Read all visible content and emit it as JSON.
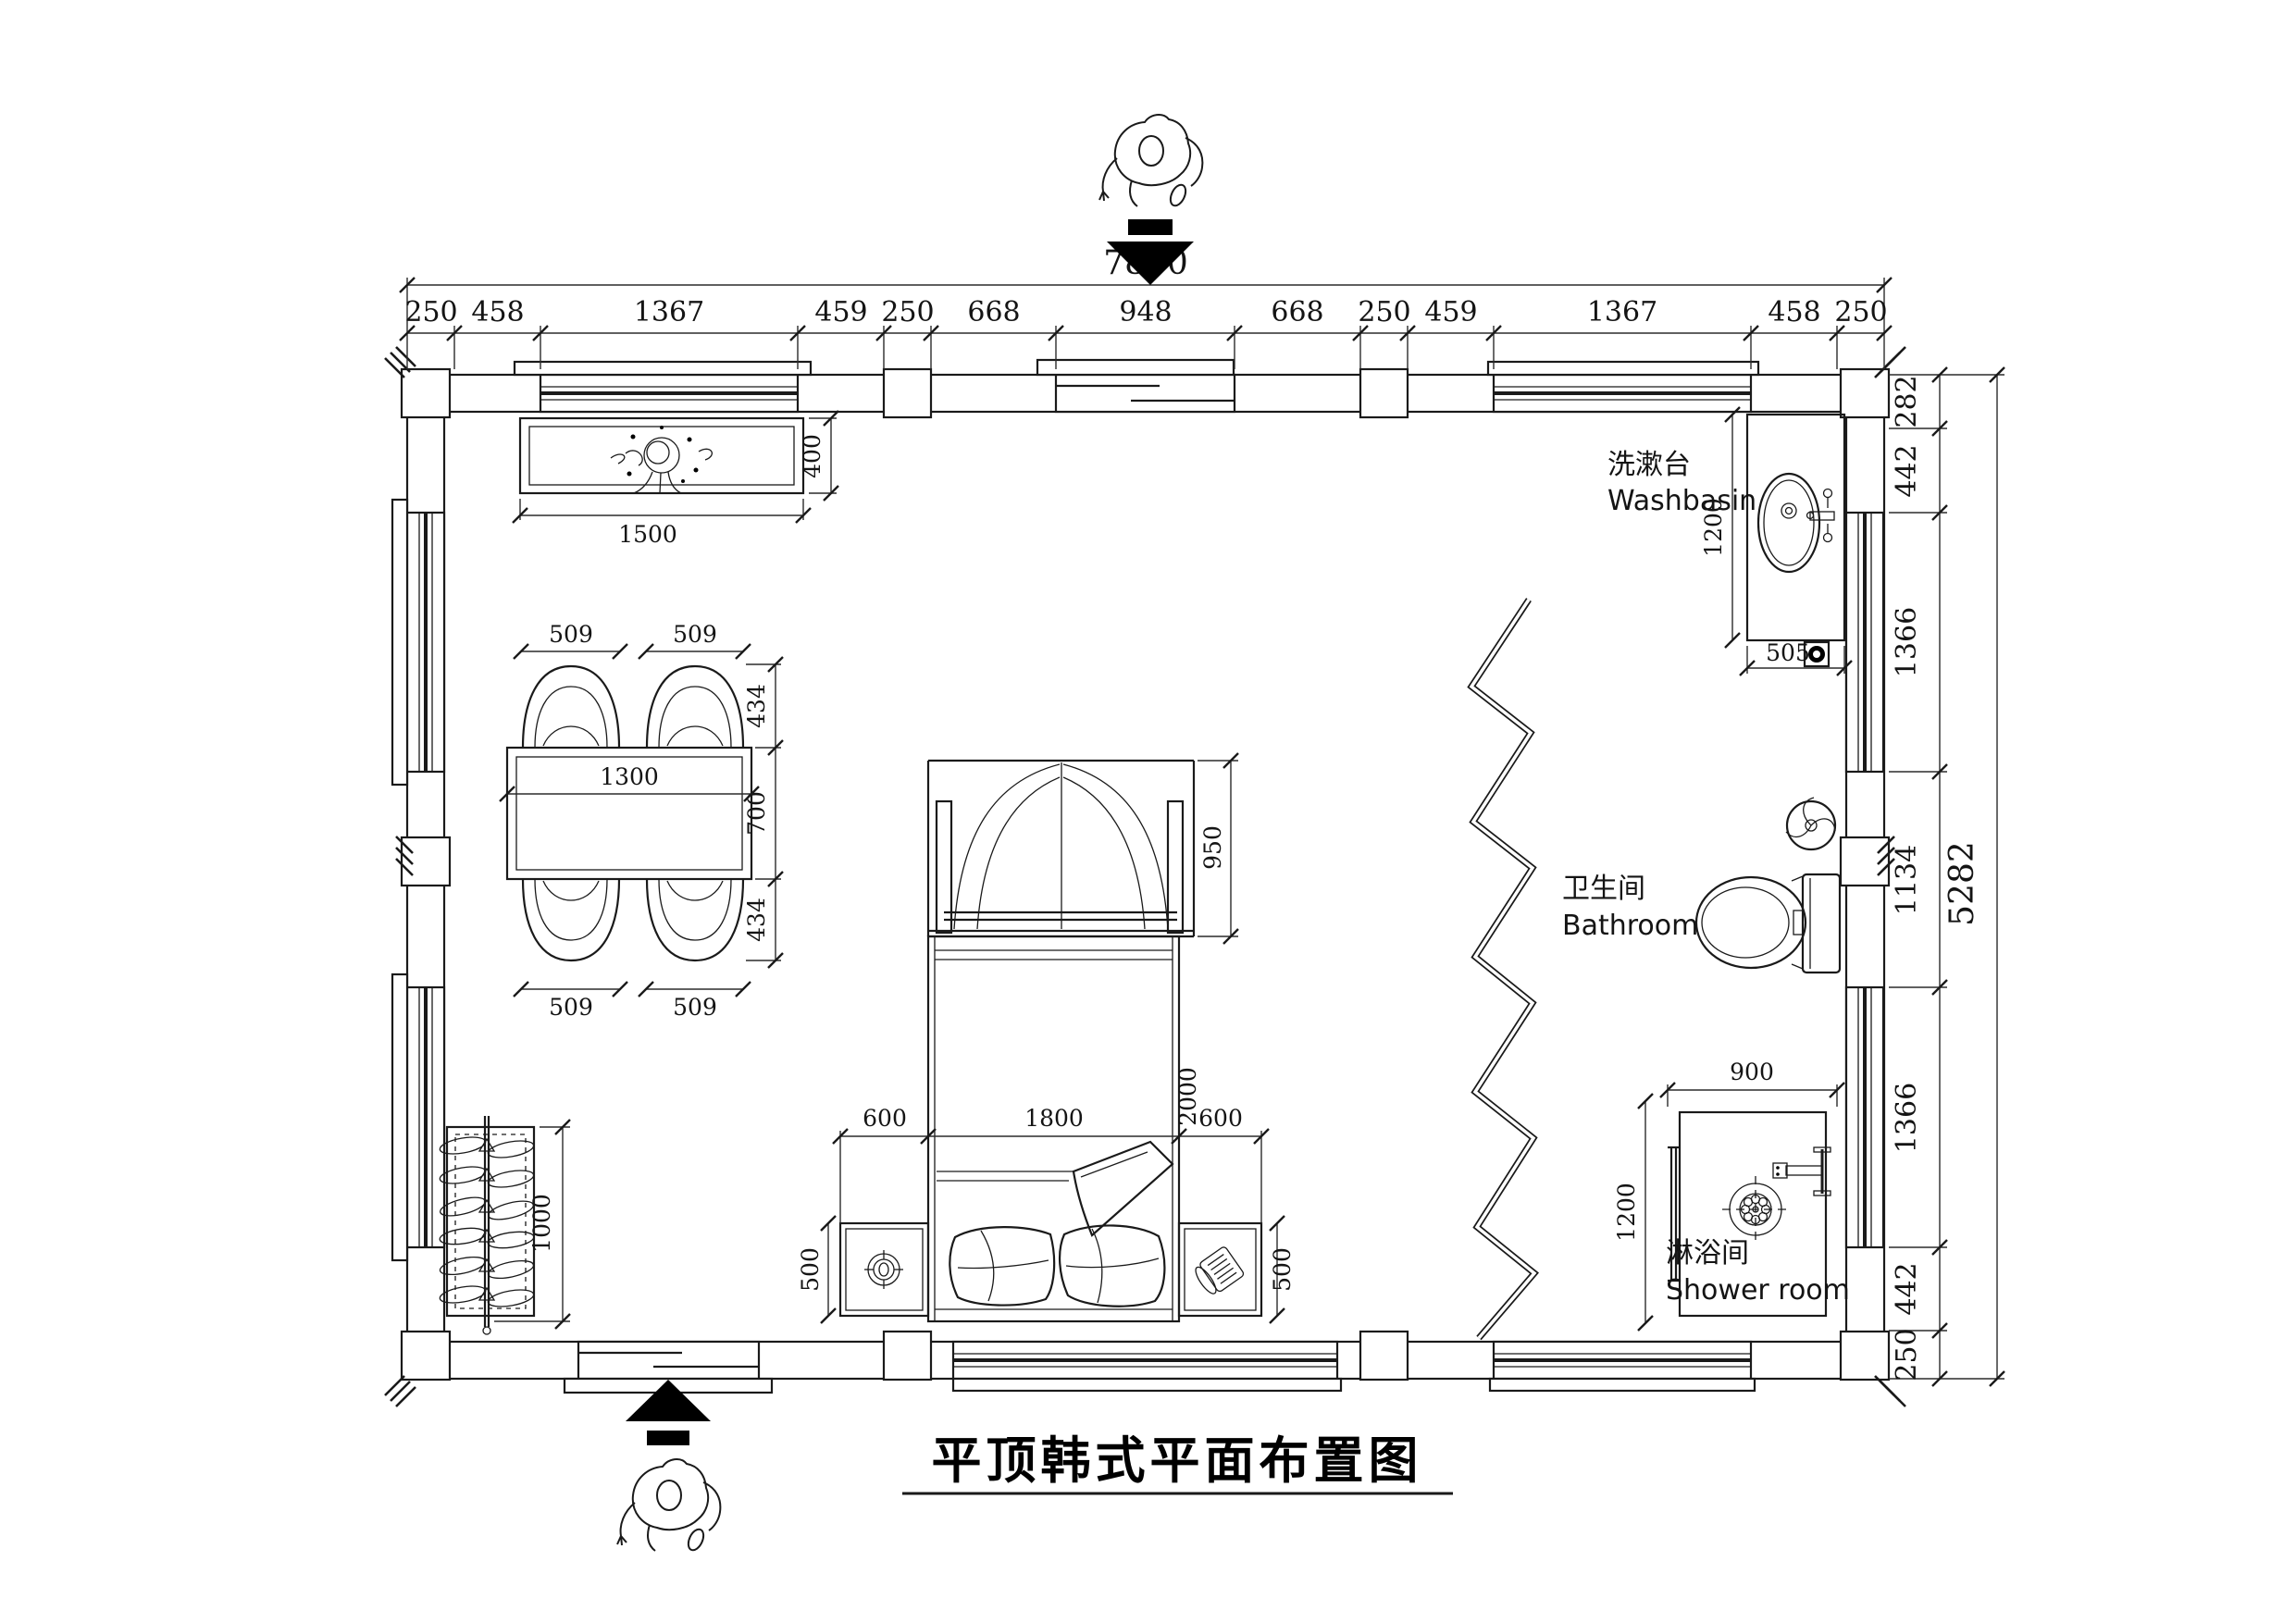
{
  "title": "平顶韩式平面布置图",
  "dimensions": {
    "top": {
      "overall": "7850",
      "segments": [
        "250",
        "458",
        "1367",
        "459",
        "250",
        "668",
        "948",
        "668",
        "250",
        "459",
        "1367",
        "458",
        "250"
      ]
    },
    "right": {
      "overall": "5282",
      "segments": [
        "282",
        "442",
        "1366",
        "1134",
        "1366",
        "442",
        "250"
      ]
    },
    "cabinet": {
      "length": "1500",
      "depth": "400"
    },
    "dining": {
      "table_length": "1300",
      "table_depth": "700",
      "chair_width": "509",
      "chair_depth": "434"
    },
    "bed": {
      "side_left": "600",
      "width": "1800",
      "side_right": "600",
      "length": "2000",
      "headboard": "950"
    },
    "nightstand_depth": "500",
    "wardrobe_length": "1000",
    "washbasin": {
      "counter_length": "1200",
      "counter_width": "505"
    },
    "shower": {
      "width": "900",
      "depth": "1200"
    }
  },
  "labels": {
    "washbasin": {
      "zh": "洗漱台",
      "en": "Washbasin"
    },
    "bathroom": {
      "zh": "卫生间",
      "en": "Bathroom"
    },
    "shower": {
      "zh": "淋浴间",
      "en": "Shower room"
    }
  }
}
